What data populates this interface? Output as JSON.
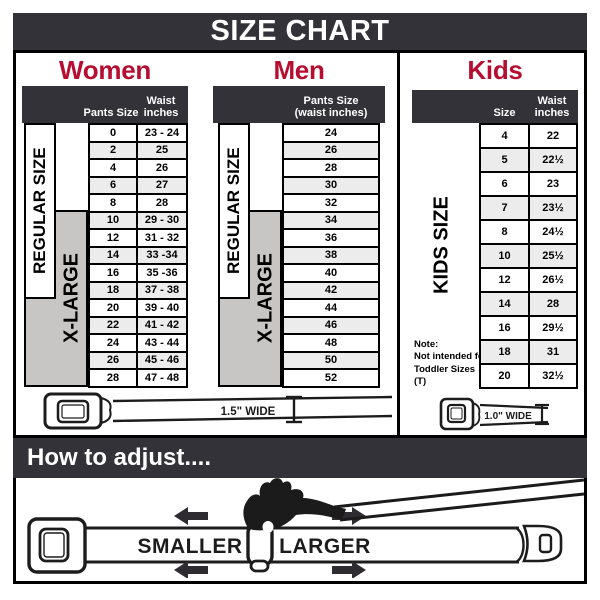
{
  "title": "SIZE CHART",
  "colors": {
    "accent": "#b60e31",
    "bar": "#333239",
    "row_alt": "#ececec",
    "side_gray": "#c7c6c5"
  },
  "sections": {
    "women": {
      "heading": "Women",
      "columns": {
        "size": "Pants Size",
        "waist_line1": "Waist",
        "waist_line2": "inches"
      },
      "side_labels": {
        "regular": "REGULAR SIZE",
        "xlarge": "X-LARGE"
      },
      "rows": [
        {
          "size": "0",
          "waist": "23 - 24"
        },
        {
          "size": "2",
          "waist": "25"
        },
        {
          "size": "4",
          "waist": "26"
        },
        {
          "size": "6",
          "waist": "27"
        },
        {
          "size": "8",
          "waist": "28"
        },
        {
          "size": "10",
          "waist": "29 - 30"
        },
        {
          "size": "12",
          "waist": "31 - 32"
        },
        {
          "size": "14",
          "waist": "33 -34"
        },
        {
          "size": "16",
          "waist": "35 -36"
        },
        {
          "size": "18",
          "waist": "37 - 38"
        },
        {
          "size": "20",
          "waist": "39 - 40"
        },
        {
          "size": "22",
          "waist": "41 - 42"
        },
        {
          "size": "24",
          "waist": "43 - 44"
        },
        {
          "size": "26",
          "waist": "45 - 46"
        },
        {
          "size": "28",
          "waist": "47 - 48"
        }
      ]
    },
    "men": {
      "heading": "Men",
      "columns": {
        "header_line1": "Pants Size",
        "header_line2": "(waist inches)"
      },
      "side_labels": {
        "regular": "REGULAR SIZE",
        "xlarge": "X-LARGE"
      },
      "rows": [
        "24",
        "26",
        "28",
        "30",
        "32",
        "34",
        "36",
        "38",
        "40",
        "42",
        "44",
        "46",
        "48",
        "50",
        "52"
      ]
    },
    "kids": {
      "heading": "Kids",
      "columns": {
        "size": "Size",
        "waist_line1": "Waist",
        "waist_line2": "inches"
      },
      "side_label": "KIDS SIZE",
      "note": {
        "label": "Note:",
        "line1": "Not intended for",
        "line2": "Toddler Sizes (T)"
      },
      "rows": [
        {
          "size": "4",
          "waist": "22"
        },
        {
          "size": "5",
          "waist": "22½"
        },
        {
          "size": "6",
          "waist": "23"
        },
        {
          "size": "7",
          "waist": "23½"
        },
        {
          "size": "8",
          "waist": "24½"
        },
        {
          "size": "10",
          "waist": "25½"
        },
        {
          "size": "12",
          "waist": "26½"
        },
        {
          "size": "14",
          "waist": "28"
        },
        {
          "size": "16",
          "waist": "29½"
        },
        {
          "size": "18",
          "waist": "31"
        },
        {
          "size": "20",
          "waist": "32½"
        }
      ]
    }
  },
  "belts": {
    "adult_label": "1.5\" WIDE",
    "kids_label": "1.0\" WIDE"
  },
  "how_to": {
    "heading": "How to adjust....",
    "smaller": "SMALLER",
    "larger": "LARGER"
  }
}
